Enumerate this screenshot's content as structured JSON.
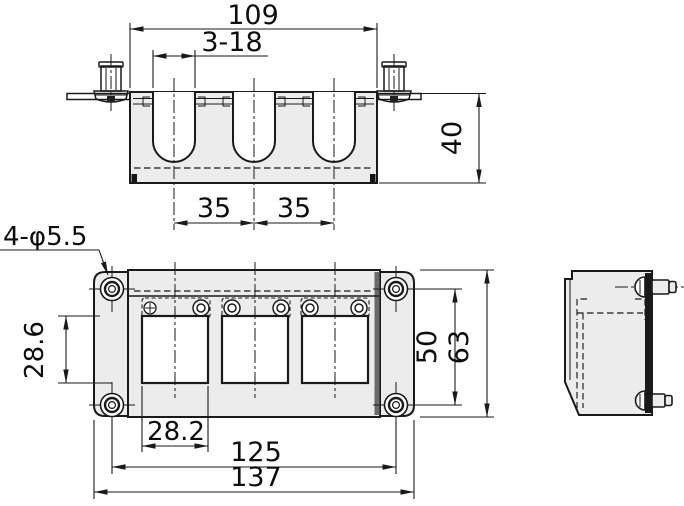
{
  "drawing": {
    "kind": "engineering-orthographic-views",
    "dimensions": {
      "top_overall_width": "109",
      "slot_count_size": "3-18",
      "depth": "40",
      "slot_pitch_a": "35",
      "slot_pitch_b": "35",
      "corner_hole_spec": "4-φ5.5",
      "opening_height": "28.6",
      "mounting_pitch_vertical": "50",
      "overall_height": "63",
      "opening_width": "28.2",
      "mounting_pitch_horizontal": "125",
      "overall_width": "137"
    },
    "colors": {
      "line": "#1a1a1a",
      "body_fill": "#ececec",
      "shadow_edge": "#6a6a6a",
      "background": "#ffffff"
    }
  }
}
